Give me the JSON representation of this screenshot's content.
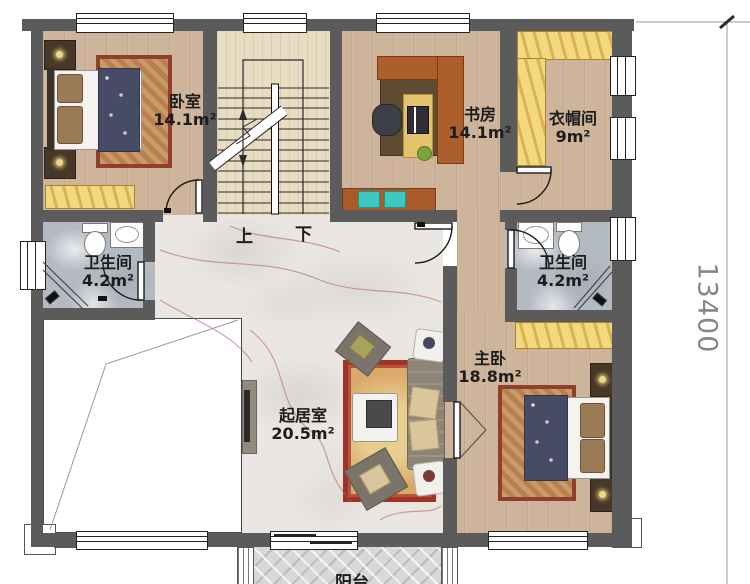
{
  "plan_title": "second-floor-plan",
  "rooms": [
    {
      "id": "bedroom",
      "name": "卧室",
      "area": "14.1m²"
    },
    {
      "id": "study",
      "name": "书房",
      "area": "14.1m²"
    },
    {
      "id": "cloakroom",
      "name": "衣帽间",
      "area": "9m²"
    },
    {
      "id": "bath_left",
      "name": "卫生间",
      "area": "4.2m²"
    },
    {
      "id": "bath_right",
      "name": "卫生间",
      "area": "4.2m²"
    },
    {
      "id": "master",
      "name": "主卧",
      "area": "18.8m²"
    },
    {
      "id": "living",
      "name": "起居室",
      "area": "20.5m²"
    },
    {
      "id": "balcony",
      "name": "阳台",
      "area": ""
    }
  ],
  "stairs": {
    "up": "上",
    "down": "下"
  },
  "dimension": {
    "right_mm": "13400"
  },
  "colors": {
    "wall": "#5b5b5b",
    "wood_floor": "#cdb49a",
    "stair_floor": "#e8dcc2",
    "living_marble": "#eae7e3",
    "bath_marble": "#b4bac2",
    "wardrobe_yellow": "#f2d87e",
    "rug_red": "#a03228",
    "blanket_navy": "#474b66",
    "furniture_brown": "#a85a28",
    "dimension_text": "#868686"
  }
}
